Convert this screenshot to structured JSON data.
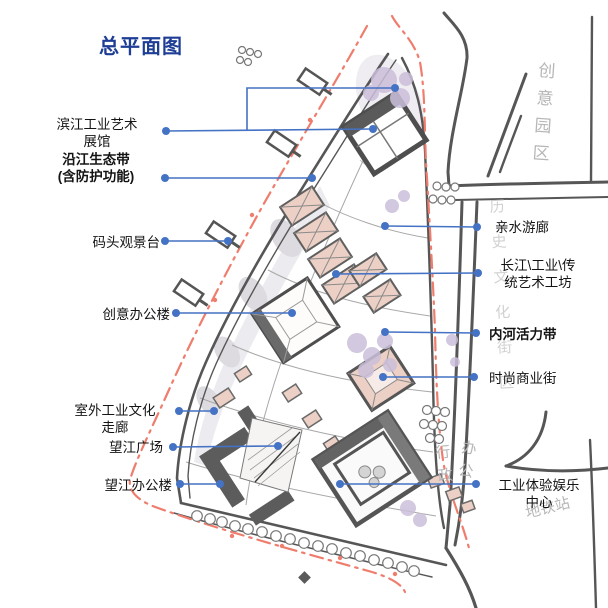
{
  "title": "总平面图",
  "colors": {
    "title_blue": "#1e3e96",
    "leader_blue": "#4472c4",
    "red_line": "#ef7d6d",
    "roof_salmon": "#ecd0c5",
    "tree_lavender": "#cbbfda",
    "road_gray": "#565656"
  },
  "labels": {
    "left": [
      {
        "id": "binjiang-gallery",
        "lines": [
          "滨江工业艺术",
          "展馆"
        ],
        "bold": false
      },
      {
        "id": "riverside-eco-belt",
        "lines": [
          "沿江生态带",
          "(含防护功能)"
        ],
        "bold": true
      },
      {
        "id": "dock-viewing-platform",
        "lines": [
          "码头观景台"
        ],
        "bold": false
      },
      {
        "id": "creative-office",
        "lines": [
          "创意办公楼"
        ],
        "bold": false
      },
      {
        "id": "outdoor-industrial-corridor",
        "lines": [
          "室外工业文化",
          "走廊"
        ],
        "bold": false
      },
      {
        "id": "wangjiang-plaza",
        "lines": [
          "望江广场"
        ],
        "bold": false
      },
      {
        "id": "wangjiang-office",
        "lines": [
          "望江办公楼"
        ],
        "bold": false
      }
    ],
    "right": [
      {
        "id": "waterfront-gallery",
        "lines": [
          "亲水游廊"
        ],
        "bold": false
      },
      {
        "id": "art-workshops",
        "lines": [
          "长江\\工业\\传",
          "统艺术工坊"
        ],
        "bold": false
      },
      {
        "id": "inner-river-belt",
        "lines": [
          "内河活力带"
        ],
        "bold": true
      },
      {
        "id": "fashion-street",
        "lines": [
          "时尚商业街"
        ],
        "bold": false
      },
      {
        "id": "industrial-entertainment",
        "lines": [
          "工业体验娱乐",
          "中心"
        ],
        "bold": false
      }
    ]
  },
  "annotations": {
    "creative_park": "创意园区",
    "district_note": "历史文化街区",
    "admin_col1": "行政",
    "admin_col2": "办公",
    "metro": "地铁站"
  }
}
